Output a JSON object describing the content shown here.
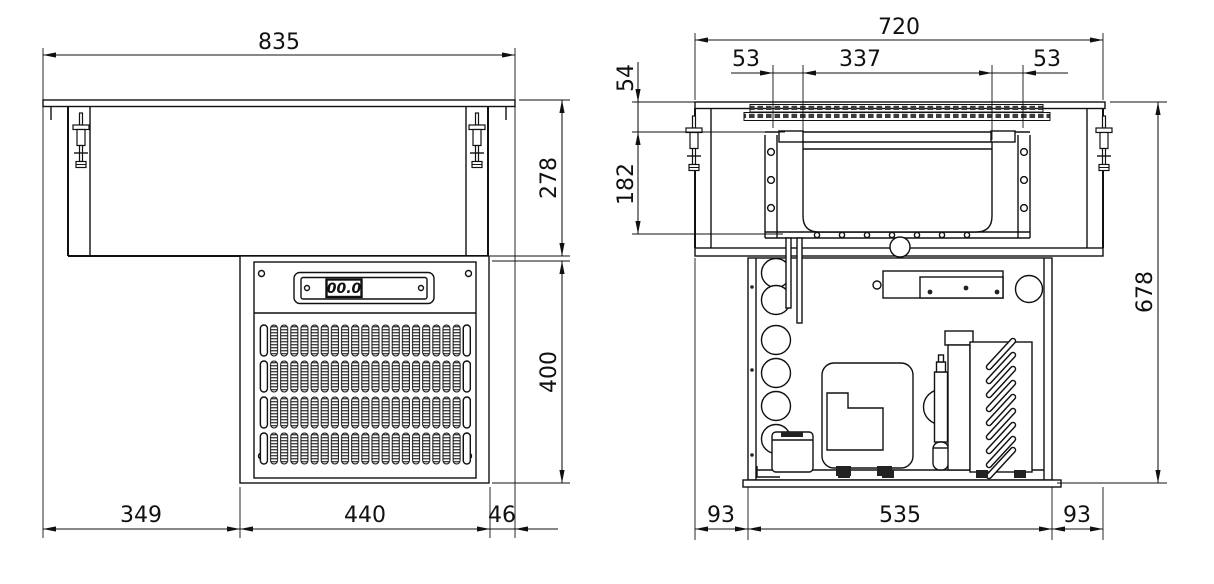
{
  "drawing_title": "drop-in refrigerated unit installation drawing",
  "front_view": {
    "display_value": "00.0",
    "dims": {
      "overall_width": "835",
      "counter_to_bottom": "278",
      "engine_height": "400",
      "left_offset": "349",
      "engine_width": "440",
      "right_offset": "46"
    }
  },
  "side_view": {
    "dims": {
      "overall_width": "720",
      "left_rim": "53",
      "pan_opening": "337",
      "right_rim": "53",
      "rim_height": "54",
      "well_depth": "182",
      "overall_height": "678",
      "left_margin": "93",
      "engine_depth": "535",
      "right_margin": "93"
    }
  },
  "colors": {
    "line": "#111111",
    "background": "#ffffff"
  }
}
